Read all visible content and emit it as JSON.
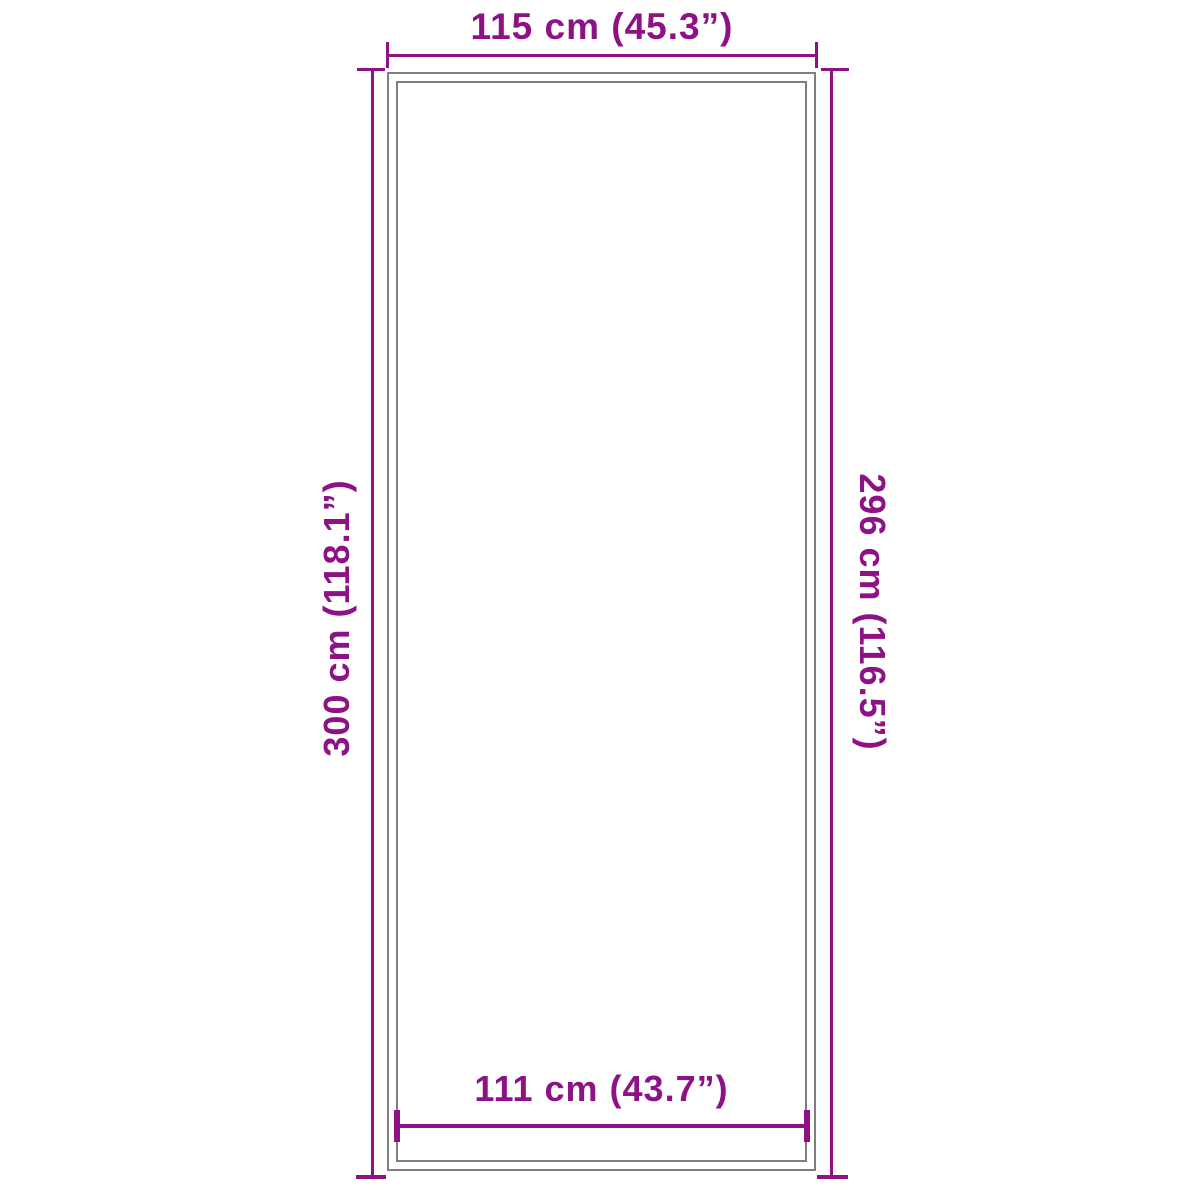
{
  "diagram": {
    "type": "product-dimension-diagram",
    "subject": "rectangular mat outline",
    "background_color": "#ffffff",
    "accent_color": "#8E1285",
    "border_color": "#7f7f7f",
    "dimensions": {
      "top": {
        "label": "115 cm (45.3”)",
        "cm": 115,
        "inches": 45.3,
        "side": "top outer width"
      },
      "left": {
        "label": "300 cm (118.1”)",
        "cm": 300,
        "inches": 118.1,
        "side": "left outer height"
      },
      "right": {
        "label": "296 cm (116.5”)",
        "cm": 296,
        "inches": 116.5,
        "side": "right inner height"
      },
      "bottom": {
        "label": "111 cm (43.7”)",
        "cm": 111,
        "inches": 43.7,
        "side": "bottom inner width"
      }
    }
  }
}
